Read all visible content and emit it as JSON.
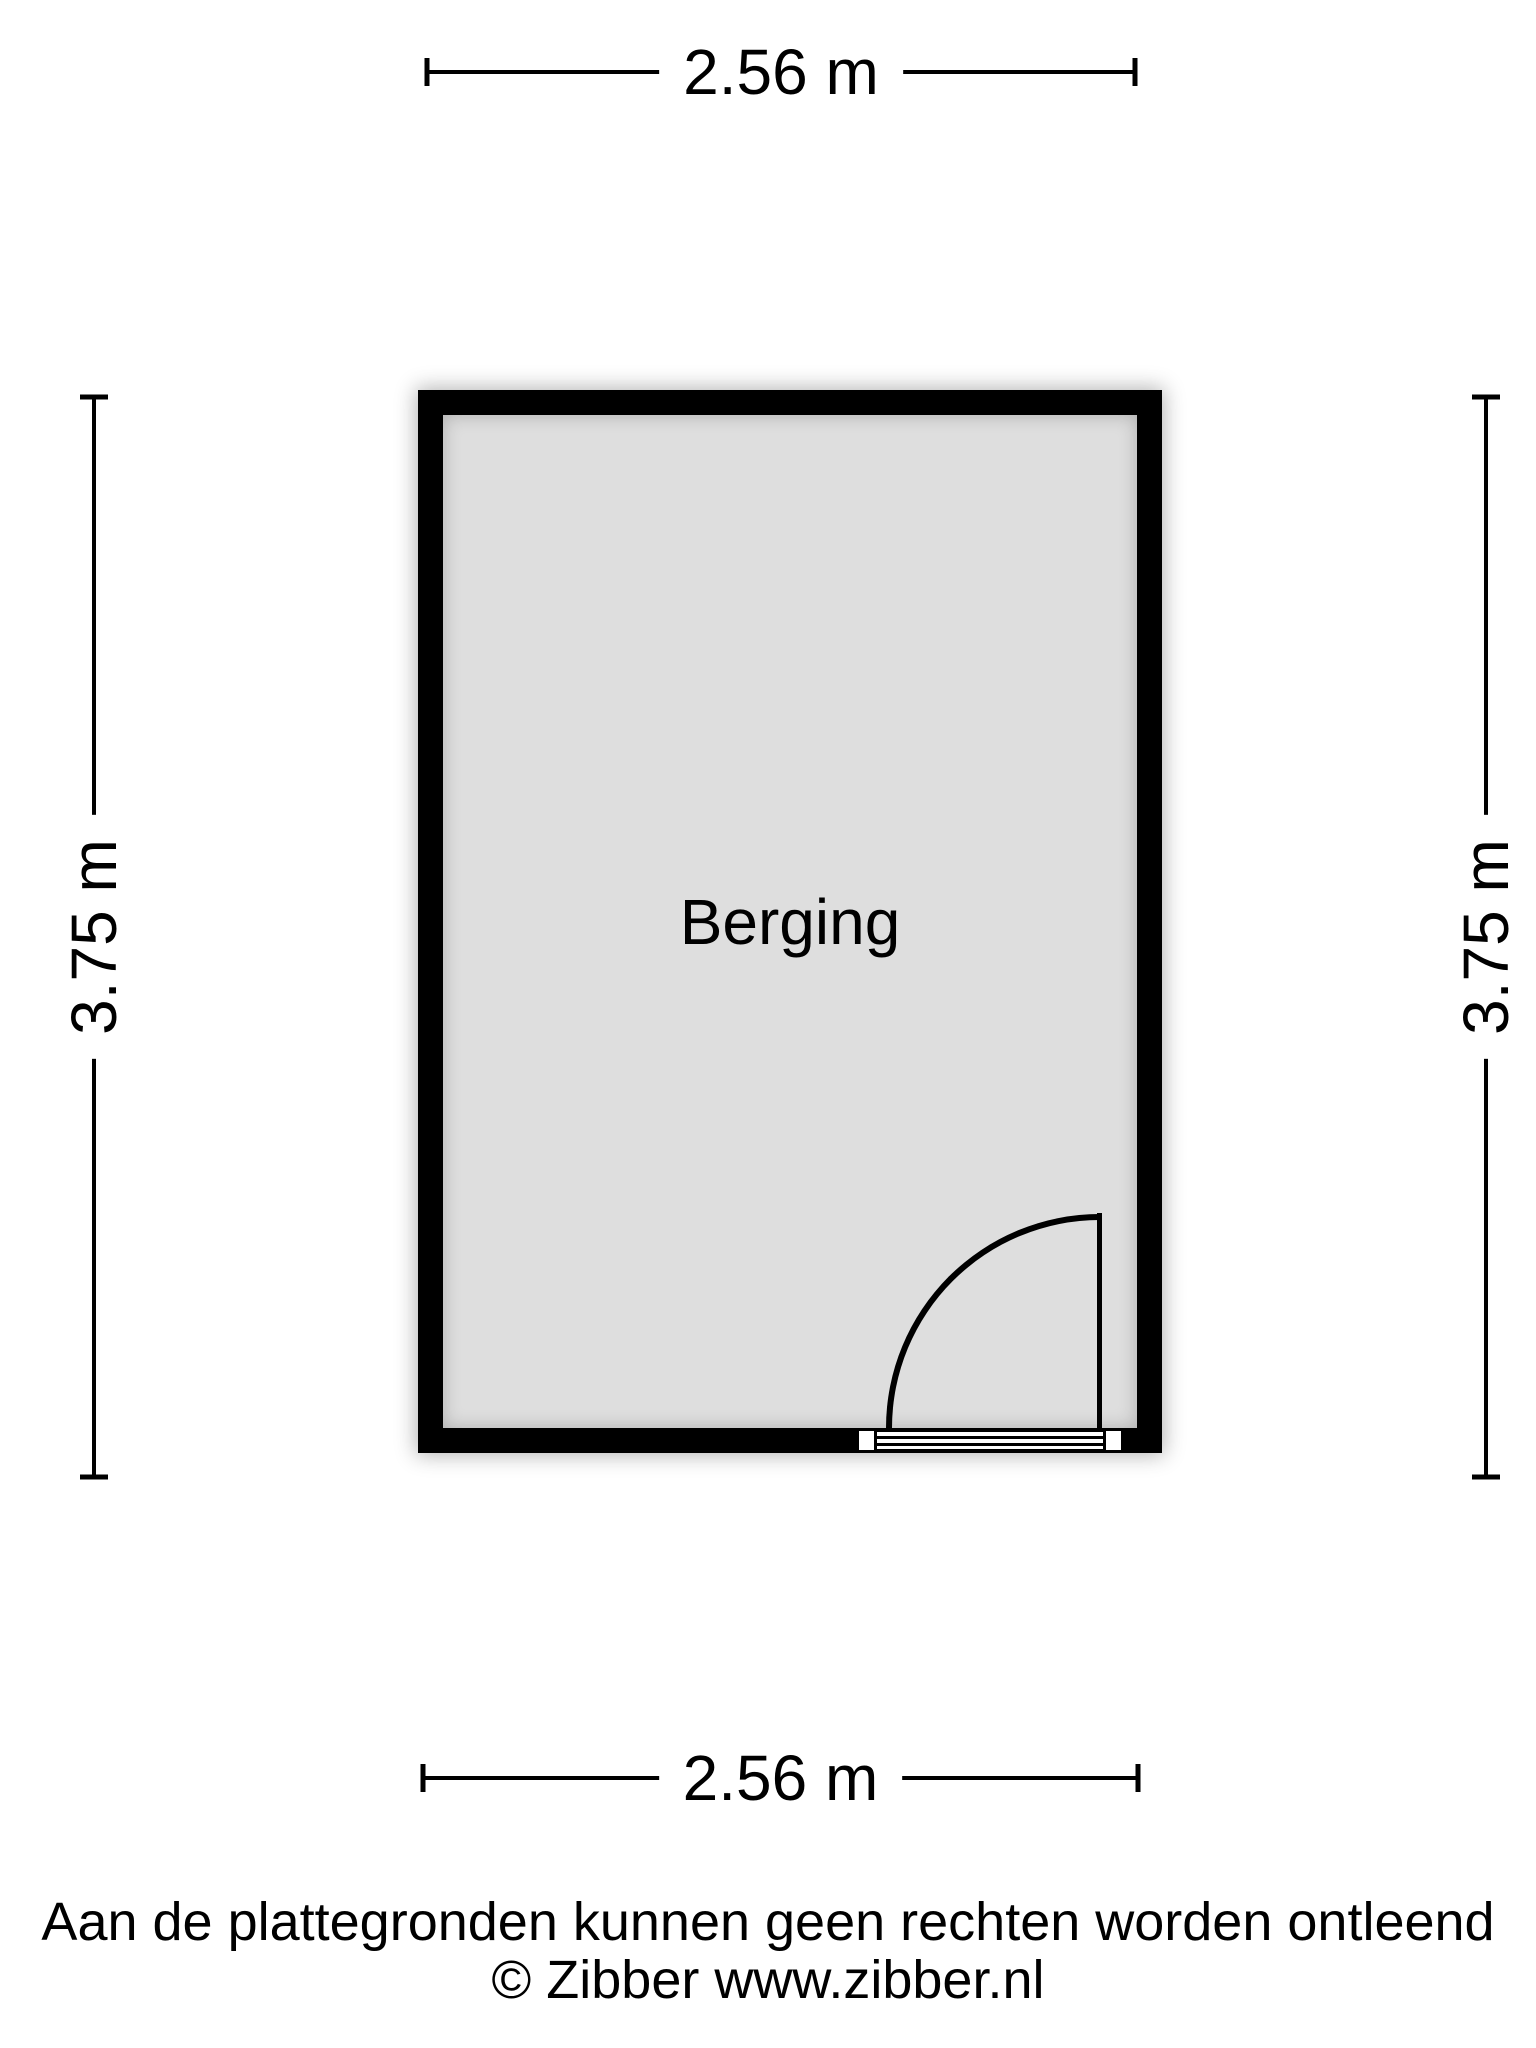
{
  "floorplan": {
    "room_label": "Berging",
    "dimensions": {
      "width": "2.56 m",
      "height": "3.75 m"
    },
    "colors": {
      "wall": "#000000",
      "floor_fill": "#dedede",
      "background": "#ffffff",
      "text": "#000000"
    }
  },
  "footer": {
    "disclaimer": "Aan de plattegronden kunnen geen rechten worden ontleend",
    "credit": "© Zibber www.zibber.nl"
  }
}
